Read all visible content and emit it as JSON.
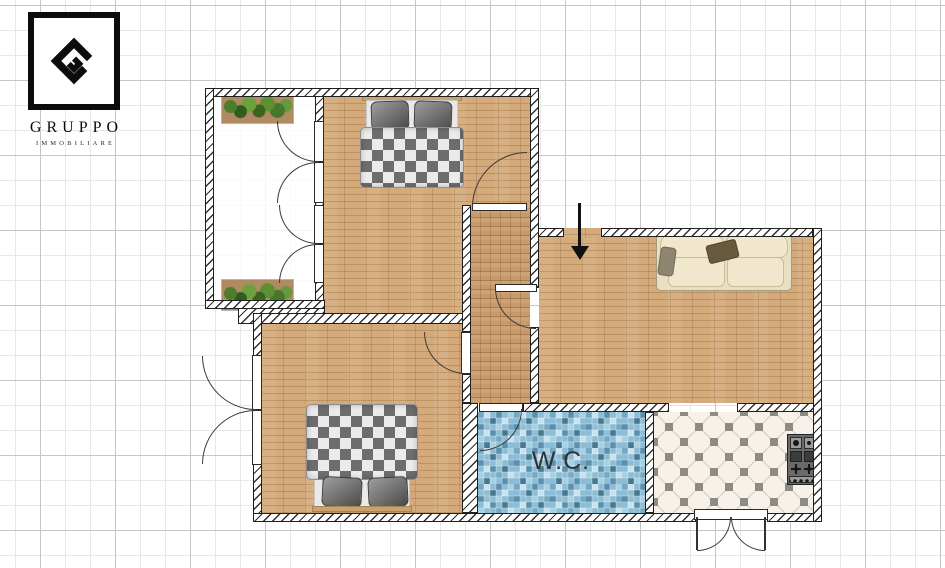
{
  "brand": {
    "name": "GRUPPO",
    "tagline": "IMMOBILIARE"
  },
  "labels": {
    "wc": "W.C."
  },
  "icons": {
    "entrance": "entrance-arrow-icon",
    "logo": "gruppo-diamond-monogram-icon"
  },
  "colors": {
    "wood_floor": "#d4aa7b",
    "hall_parquet": "#c99a69",
    "wc_tile_base": "#8cbdd6",
    "kitchen_tile_base": "#f7f1e9",
    "kitchen_tile_dot": "#8c8c85",
    "sofa": "#e9dfc3",
    "duvet_check_dark": "#6d6d6d",
    "duvet_check_light": "#ebebeb",
    "wall_fill": "#ffffff",
    "wall_line": "#1f1f1f",
    "logo_ink": "#0c0c0c"
  }
}
